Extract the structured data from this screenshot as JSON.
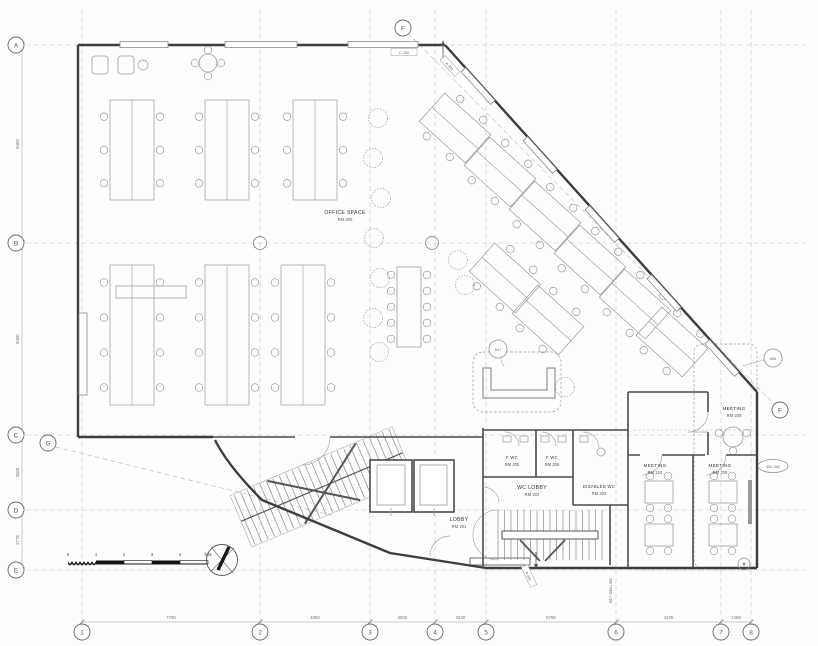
{
  "drawing": {
    "type_label": "floor-plan",
    "north_indicator": "north-arrow"
  },
  "grids": {
    "rows": [
      "A",
      "B",
      "C",
      "D",
      "E"
    ],
    "cols": [
      "1",
      "2",
      "3",
      "4",
      "5",
      "6",
      "7",
      "8"
    ],
    "diag_top": "F",
    "diag_right": "F",
    "aux": "G"
  },
  "dimensions": {
    "left": [
      "8400",
      "8400",
      "3000",
      "2775"
    ],
    "bottom": [
      "7790",
      "4850",
      "2850",
      "2340",
      "5790",
      "4425",
      "1388"
    ],
    "key_dim_note": "KEY DIM LINE"
  },
  "rooms": {
    "office": {
      "name": "OFFICE SPACE",
      "number": "RM 200"
    },
    "lobby": {
      "name": "LOBBY",
      "number": "RM 201"
    },
    "wc_lobby": {
      "name": "WC LOBBY",
      "number": "RM 202"
    },
    "disabled_wc": {
      "name": "DISABLED WC",
      "number": "RM 203"
    },
    "fwc1": {
      "name": "F WC",
      "number": "RM 205"
    },
    "fwc2": {
      "name": "F WC",
      "number": "RM 206"
    },
    "meeting208": {
      "name": "MEETING",
      "number": "RM 208"
    },
    "meeting209": {
      "name": "MEETING",
      "number": "RM 209"
    },
    "meeting210": {
      "name": "MEETING",
      "number": "RM 210"
    }
  },
  "tags": {
    "sofa_tag": "A07",
    "zone_tag": "606",
    "level_tag": "352-352",
    "wall_tag": "C-100",
    "section_tag": "A-301"
  },
  "scalebar": {
    "ticks": [
      "0",
      "1",
      "2",
      "3",
      "4"
    ],
    "end_label": "5 M"
  },
  "colors": {
    "wall": "#3d3d3d",
    "partition": "#4a4a4a",
    "furniture": "#9a9a9a",
    "grid": "#c4c4c4",
    "dashed_zone": "#8a8a8a"
  }
}
